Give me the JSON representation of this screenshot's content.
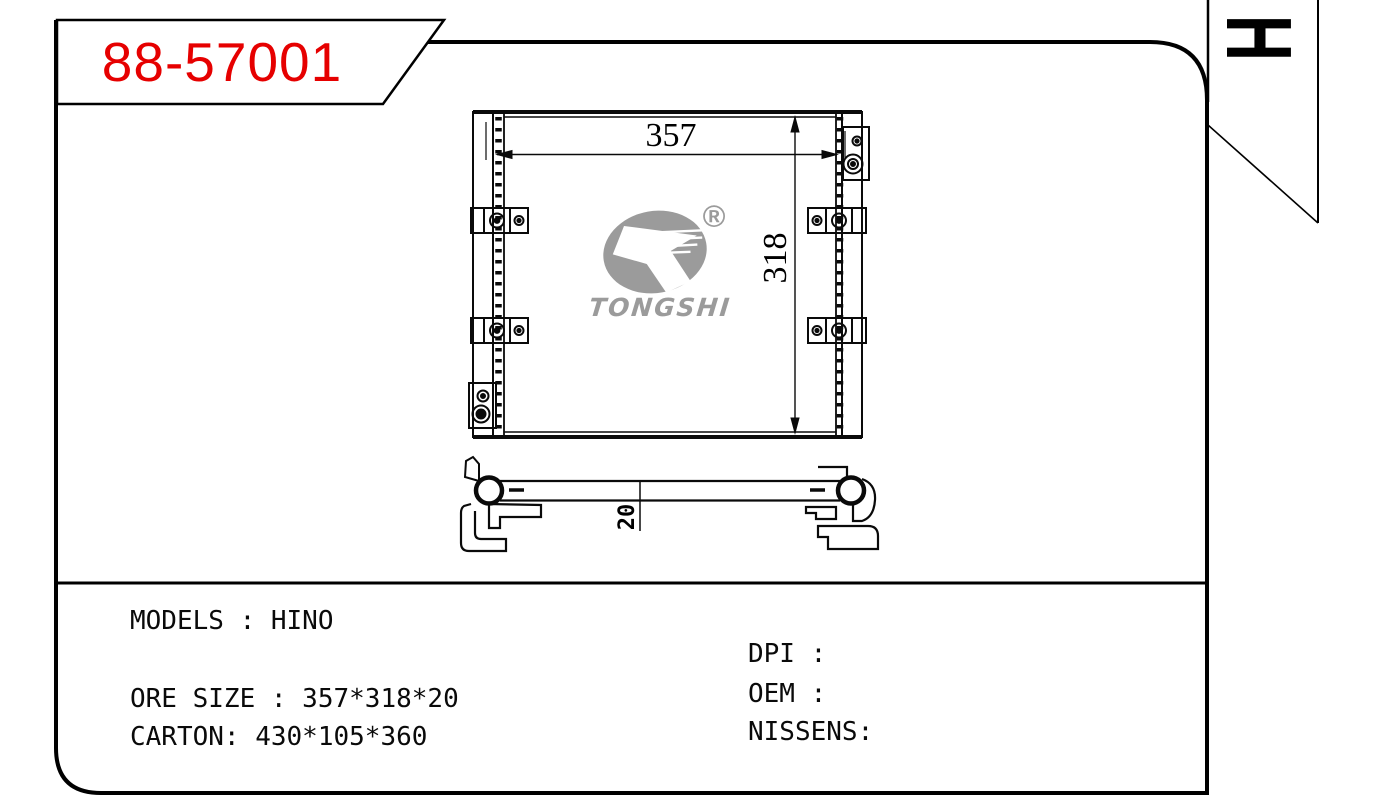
{
  "badge": {
    "part_number": "88-57001"
  },
  "corner_tab": {
    "label": "H"
  },
  "front_view": {
    "width_dim": "357",
    "height_dim": "318"
  },
  "side_view": {
    "thickness_dim": "20"
  },
  "logo": {
    "brand": "TONGSHI",
    "registered": "®"
  },
  "specs": {
    "models": "MODELS : HINO",
    "core_size": "ORE SIZE : 357*318*20",
    "carton": "CARTON: 430*105*360",
    "dpi": "DPI :",
    "oem": "OEM :",
    "nissens": "NISSENS:"
  },
  "colors": {
    "part_number_red": "#e60000",
    "line_black": "#000000",
    "logo_gray": "#9b9b9b"
  }
}
